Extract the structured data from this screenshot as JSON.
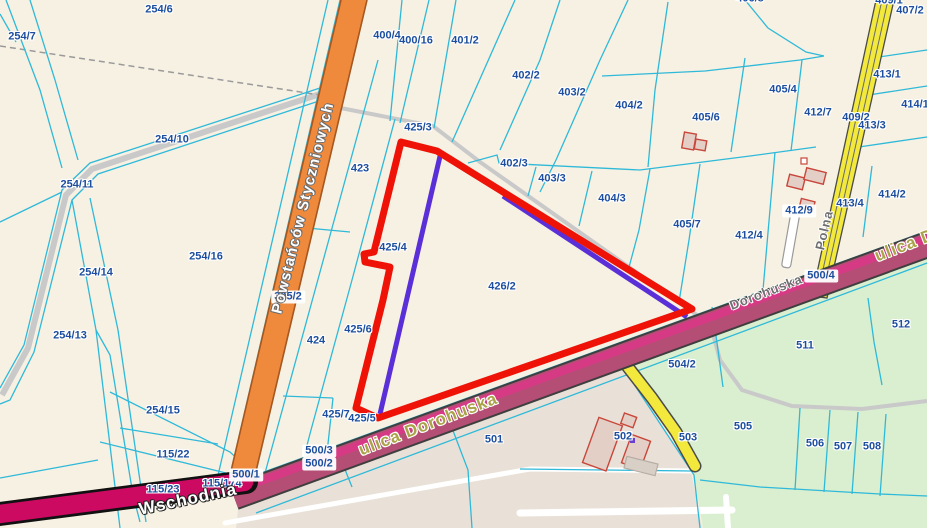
{
  "map": {
    "description": "Cadastral parcel map",
    "colors": {
      "background": "#f7f1e3",
      "parcel_line_cyan": "#2fb9d9",
      "parcel_label_blue": "#1d4e9e",
      "highlight_red": "#ee1207",
      "measure_purple": "#5a2fd8",
      "road_orange": "#ef8a3d",
      "road_yellow": "#f2e93c",
      "road_magenta_fill": "#b54e74",
      "road_magenta_stripe": "#d63a85",
      "road_crimson": "#cc0a62",
      "road_gray": "#c9c9c9",
      "area_green": "#d9efd0",
      "area_beige": "#e9e1d7",
      "street_khaki": "#aaa348",
      "street_gray": "#6f6f6f",
      "street_white": "#ffffff"
    },
    "parcel_labels": [
      {
        "text": "254/6",
        "x": 159,
        "y": 10
      },
      {
        "text": "254/7",
        "x": 22,
        "y": 37
      },
      {
        "text": "254/10",
        "x": 172,
        "y": 140
      },
      {
        "text": "254/11",
        "x": 77,
        "y": 185
      },
      {
        "text": "254/14",
        "x": 96,
        "y": 273
      },
      {
        "text": "254/16",
        "x": 206,
        "y": 257
      },
      {
        "text": "254/13",
        "x": 70,
        "y": 336
      },
      {
        "text": "254/15",
        "x": 163,
        "y": 411
      },
      {
        "text": "115/22",
        "x": 173,
        "y": 455
      },
      {
        "text": "115/23",
        "x": 163,
        "y": 490
      },
      {
        "text": "115/174",
        "x": 222,
        "y": 484
      },
      {
        "text": "305/2",
        "x": 288,
        "y": 297,
        "boxed": true
      },
      {
        "text": "424",
        "x": 316,
        "y": 341
      },
      {
        "text": "423",
        "x": 360,
        "y": 169
      },
      {
        "text": "425/3",
        "x": 418,
        "y": 128
      },
      {
        "text": "425/4",
        "x": 393,
        "y": 248
      },
      {
        "text": "425/6",
        "x": 358,
        "y": 330
      },
      {
        "text": "425/7",
        "x": 336,
        "y": 415
      },
      {
        "text": "425/5",
        "x": 362,
        "y": 419
      },
      {
        "text": "426/2",
        "x": 502,
        "y": 287
      },
      {
        "text": "402/3",
        "x": 514,
        "y": 164
      },
      {
        "text": "403/3",
        "x": 552,
        "y": 179
      },
      {
        "text": "404/3",
        "x": 612,
        "y": 199
      },
      {
        "text": "400/4",
        "x": 387,
        "y": 36
      },
      {
        "text": "400/16",
        "x": 416,
        "y": 41
      },
      {
        "text": "401/2",
        "x": 465,
        "y": 41
      },
      {
        "text": "402/2",
        "x": 526,
        "y": 76
      },
      {
        "text": "403/2",
        "x": 572,
        "y": 93
      },
      {
        "text": "404/2",
        "x": 629,
        "y": 106
      },
      {
        "text": "406/8",
        "x": 750,
        "y": -1
      },
      {
        "text": "405/6",
        "x": 706,
        "y": 118
      },
      {
        "text": "405/4",
        "x": 783,
        "y": 90
      },
      {
        "text": "412/7",
        "x": 818,
        "y": 113
      },
      {
        "text": "409/2",
        "x": 856,
        "y": 118
      },
      {
        "text": "413/3",
        "x": 872,
        "y": 126
      },
      {
        "text": "413/1",
        "x": 887,
        "y": 75
      },
      {
        "text": "414/1",
        "x": 915,
        "y": 105
      },
      {
        "text": "407/2",
        "x": 910,
        "y": 11
      },
      {
        "text": "409/1",
        "x": 889,
        "y": 1
      },
      {
        "text": "405/7",
        "x": 687,
        "y": 225
      },
      {
        "text": "412/4",
        "x": 749,
        "y": 236
      },
      {
        "text": "412/9",
        "x": 799,
        "y": 211,
        "boxed": true
      },
      {
        "text": "413/4",
        "x": 850,
        "y": 204
      },
      {
        "text": "414/2",
        "x": 892,
        "y": 195
      },
      {
        "text": "500/4",
        "x": 821,
        "y": 276,
        "boxed": true
      },
      {
        "text": "500/1",
        "x": 246,
        "y": 475,
        "boxed": true
      },
      {
        "text": "500/3",
        "x": 319,
        "y": 451,
        "boxed": true
      },
      {
        "text": "500/2",
        "x": 319,
        "y": 464,
        "boxed": true
      },
      {
        "text": "501",
        "x": 494,
        "y": 440
      },
      {
        "text": "502",
        "x": 623,
        "y": 437
      },
      {
        "text": "503",
        "x": 688,
        "y": 438
      },
      {
        "text": "504/2",
        "x": 682,
        "y": 365
      },
      {
        "text": "511",
        "x": 805,
        "y": 346
      },
      {
        "text": "512",
        "x": 901,
        "y": 325
      },
      {
        "text": "505",
        "x": 743,
        "y": 427
      },
      {
        "text": "506",
        "x": 815,
        "y": 444
      },
      {
        "text": "507",
        "x": 843,
        "y": 447
      },
      {
        "text": "508",
        "x": 872,
        "y": 447
      }
    ],
    "street_labels": [
      {
        "text": "Powstańców Styczniowych",
        "x": 303,
        "y": 208,
        "rot": -76,
        "style": "road-white",
        "size": 15
      },
      {
        "text": "ulica Dorohuska",
        "x": 428,
        "y": 424,
        "rot": -21,
        "style": "road-khaki",
        "size": 17
      },
      {
        "text": "ulica Dorohuska",
        "x": 944,
        "y": 230,
        "rot": -21,
        "style": "road-khaki",
        "size": 17
      },
      {
        "text": "Dorohuska",
        "x": 766,
        "y": 292,
        "rot": -21,
        "style": "road-gray",
        "size": 13
      },
      {
        "text": "Wschodnia",
        "x": 188,
        "y": 499,
        "rot": -12,
        "style": "road-white-lg",
        "size": 17
      },
      {
        "text": "Polna",
        "x": 824,
        "y": 230,
        "rot": -77,
        "style": "road-gray",
        "size": 13
      }
    ]
  }
}
